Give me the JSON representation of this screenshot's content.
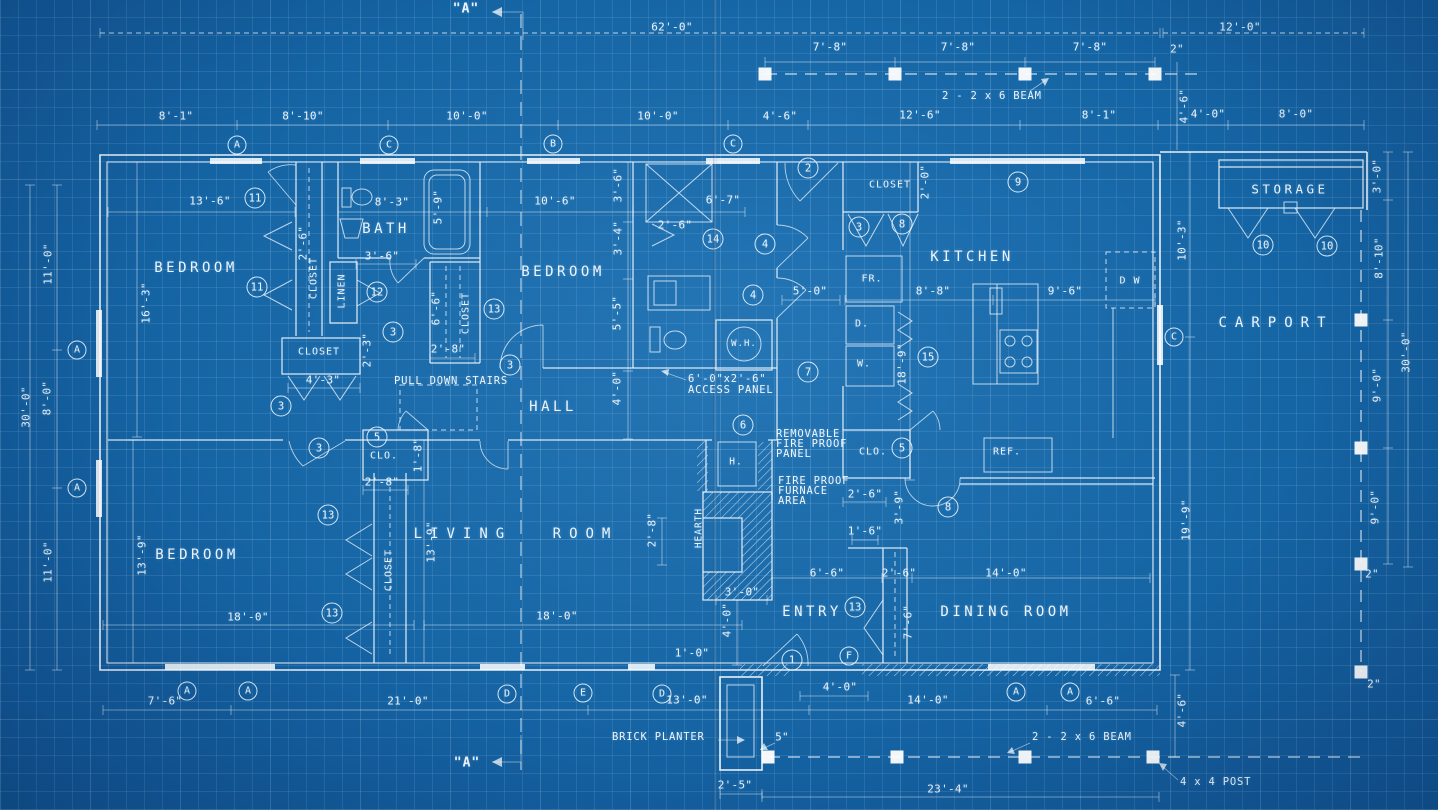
{
  "colors": {
    "paper_blue": "#1565a5",
    "line_white": "#f2f8fd",
    "grid_blue": "#add6f4"
  },
  "sections": [
    {
      "t": "\"A\"",
      "x": 466,
      "y": 9
    },
    {
      "t": "\"A\"",
      "x": 467,
      "y": 763
    }
  ],
  "rooms": [
    {
      "t": "BEDROOM",
      "x": 196,
      "y": 268
    },
    {
      "t": "BEDROOM",
      "x": 563,
      "y": 272
    },
    {
      "t": "BEDROOM",
      "x": 197,
      "y": 555
    },
    {
      "t": "BATH",
      "x": 386,
      "y": 229
    },
    {
      "t": "HALL",
      "x": 553,
      "y": 407
    },
    {
      "t": "KITCHEN",
      "x": 972,
      "y": 257
    },
    {
      "t": "LIVING ROOM",
      "x": 516,
      "y": 534,
      "w": 1
    },
    {
      "t": "ENTRY",
      "x": 812,
      "y": 612
    },
    {
      "t": "DINING ROOM",
      "x": 1006,
      "y": 612
    },
    {
      "t": "STORAGE",
      "x": 1290,
      "y": 189,
      "fs": 12.5
    },
    {
      "t": "CARPORT",
      "x": 1276,
      "y": 323,
      "w": 1
    }
  ],
  "labels": [
    {
      "t": "CLOSET",
      "x": 314,
      "y": 278,
      "r": 1
    },
    {
      "t": "LINEN",
      "x": 342,
      "y": 291,
      "r": 1
    },
    {
      "t": "CLOSET",
      "x": 319,
      "y": 352
    },
    {
      "t": "CLOSET",
      "x": 466,
      "y": 313,
      "r": 1
    },
    {
      "t": "CLOSET",
      "x": 890,
      "y": 185
    },
    {
      "t": "CLOSET",
      "x": 389,
      "y": 570,
      "r": 1
    },
    {
      "t": "CLO.",
      "x": 384,
      "y": 456
    },
    {
      "t": "CLO.",
      "x": 873,
      "y": 452
    },
    {
      "t": "FR.",
      "x": 872,
      "y": 279
    },
    {
      "t": "D.",
      "x": 862,
      "y": 324
    },
    {
      "t": "W.",
      "x": 864,
      "y": 364
    },
    {
      "t": "W.H.",
      "x": 744,
      "y": 344,
      "fs": 9
    },
    {
      "t": "REF.",
      "x": 1007,
      "y": 452
    },
    {
      "t": "D W",
      "x": 1130,
      "y": 281
    },
    {
      "t": "H.",
      "x": 736,
      "y": 462,
      "fs": 9.5
    },
    {
      "t": "HEARTH",
      "x": 699,
      "y": 528,
      "r": 1,
      "fs": 9.5
    }
  ],
  "dims": [
    {
      "t": "62'-0\"",
      "x": 672,
      "y": 27
    },
    {
      "t": "12'-0\"",
      "x": 1240,
      "y": 27
    },
    {
      "t": "7'-8\"",
      "x": 830,
      "y": 47
    },
    {
      "t": "7'-8\"",
      "x": 958,
      "y": 47
    },
    {
      "t": "7'-8\"",
      "x": 1090,
      "y": 47
    },
    {
      "t": "2\"",
      "x": 1177,
      "y": 49
    },
    {
      "t": "8'-1\"",
      "x": 176,
      "y": 116
    },
    {
      "t": "8'-10\"",
      "x": 303,
      "y": 116
    },
    {
      "t": "10'-0\"",
      "x": 467,
      "y": 116
    },
    {
      "t": "10'-0\"",
      "x": 658,
      "y": 116
    },
    {
      "t": "4'-6\"",
      "x": 780,
      "y": 116
    },
    {
      "t": "12'-6\"",
      "x": 920,
      "y": 115
    },
    {
      "t": "8'-1\"",
      "x": 1099,
      "y": 115
    },
    {
      "t": "4'-6\"",
      "x": 1184,
      "y": 106,
      "r": 1
    },
    {
      "t": "4'-0\"",
      "x": 1208,
      "y": 114
    },
    {
      "t": "8'-0\"",
      "x": 1296,
      "y": 114
    },
    {
      "t": "11'-0\"",
      "x": 48,
      "y": 264,
      "r": 1
    },
    {
      "t": "8'-0\"",
      "x": 47,
      "y": 398,
      "r": 1
    },
    {
      "t": "11'-0\"",
      "x": 48,
      "y": 562,
      "r": 1
    },
    {
      "t": "30'-0\"",
      "x": 26,
      "y": 407,
      "r": 1
    },
    {
      "t": "3'-0\"",
      "x": 1377,
      "y": 176,
      "r": 1
    },
    {
      "t": "8'-10\"",
      "x": 1379,
      "y": 258,
      "r": 1
    },
    {
      "t": "9'-0\"",
      "x": 1377,
      "y": 385,
      "r": 1
    },
    {
      "t": "9'-0\"",
      "x": 1375,
      "y": 507,
      "r": 1
    },
    {
      "t": "2\"",
      "x": 1372,
      "y": 574
    },
    {
      "t": "2\"",
      "x": 1374,
      "y": 684
    },
    {
      "t": "30'-0\"",
      "x": 1406,
      "y": 352,
      "r": 1
    },
    {
      "t": "10'-3\"",
      "x": 1182,
      "y": 240,
      "r": 1
    },
    {
      "t": "19'-9\"",
      "x": 1186,
      "y": 520,
      "r": 1
    },
    {
      "t": "13'-6\"",
      "x": 210,
      "y": 201
    },
    {
      "t": "8'-3\"",
      "x": 392,
      "y": 202
    },
    {
      "t": "3'-6\"",
      "x": 382,
      "y": 256
    },
    {
      "t": "2'-6\"",
      "x": 303,
      "y": 243,
      "r": 1
    },
    {
      "t": "2'-3\"",
      "x": 367,
      "y": 350,
      "r": 1
    },
    {
      "t": "4'-3\"",
      "x": 323,
      "y": 380
    },
    {
      "t": "16'-3\"",
      "x": 146,
      "y": 303,
      "r": 1
    },
    {
      "t": "5'-9\"",
      "x": 438,
      "y": 207,
      "r": 1
    },
    {
      "t": "10'-6\"",
      "x": 555,
      "y": 201
    },
    {
      "t": "3'-6\"",
      "x": 618,
      "y": 185,
      "r": 1
    },
    {
      "t": "3'-4\"",
      "x": 618,
      "y": 238,
      "r": 1
    },
    {
      "t": "5'-5\"",
      "x": 617,
      "y": 313,
      "r": 1
    },
    {
      "t": "4'-0\"",
      "x": 617,
      "y": 388,
      "r": 1
    },
    {
      "t": "6'-6\"",
      "x": 436,
      "y": 308,
      "r": 1
    },
    {
      "t": "2'-8\"",
      "x": 448,
      "y": 349
    },
    {
      "t": "6'-7\"",
      "x": 723,
      "y": 200
    },
    {
      "t": "2'-6\"",
      "x": 675,
      "y": 225
    },
    {
      "t": "5'-0\"",
      "x": 810,
      "y": 291
    },
    {
      "t": "2'-0\"",
      "x": 925,
      "y": 182,
      "r": 1
    },
    {
      "t": "8'-8\"",
      "x": 933,
      "y": 291
    },
    {
      "t": "9'-6\"",
      "x": 1065,
      "y": 291
    },
    {
      "t": "18'-9\"",
      "x": 902,
      "y": 364,
      "r": 1
    },
    {
      "t": "2'-8\"",
      "x": 382,
      "y": 482
    },
    {
      "t": "1'-8\"",
      "x": 418,
      "y": 455,
      "r": 1
    },
    {
      "t": "13'-9\"",
      "x": 142,
      "y": 555,
      "r": 1
    },
    {
      "t": "18'-0\"",
      "x": 248,
      "y": 617
    },
    {
      "t": "13'-9\"",
      "x": 431,
      "y": 542,
      "r": 1
    },
    {
      "t": "18'-0\"",
      "x": 557,
      "y": 616
    },
    {
      "t": "2'-8\"",
      "x": 652,
      "y": 530,
      "r": 1
    },
    {
      "t": "3'-0\"",
      "x": 742,
      "y": 592
    },
    {
      "t": "4'-0\"",
      "x": 727,
      "y": 620,
      "r": 1
    },
    {
      "t": "1'-0\"",
      "x": 692,
      "y": 653
    },
    {
      "t": "2'-6\"",
      "x": 865,
      "y": 494
    },
    {
      "t": "3'-9\"",
      "x": 899,
      "y": 507,
      "r": 1
    },
    {
      "t": "1'-6\"",
      "x": 865,
      "y": 531
    },
    {
      "t": "6'-6\"",
      "x": 827,
      "y": 573
    },
    {
      "t": "2'-6\"",
      "x": 899,
      "y": 573
    },
    {
      "t": "14'-0\"",
      "x": 1006,
      "y": 573
    },
    {
      "t": "7'-6\"",
      "x": 908,
      "y": 622,
      "r": 1
    },
    {
      "t": "7'-6\"",
      "x": 165,
      "y": 701
    },
    {
      "t": "21'-0\"",
      "x": 408,
      "y": 701
    },
    {
      "t": "13'-0\"",
      "x": 687,
      "y": 700
    },
    {
      "t": "4'-0\"",
      "x": 840,
      "y": 687
    },
    {
      "t": "14'-0\"",
      "x": 928,
      "y": 700
    },
    {
      "t": "6'-6\"",
      "x": 1103,
      "y": 701
    },
    {
      "t": "4'-6\"",
      "x": 1182,
      "y": 710,
      "r": 1
    },
    {
      "t": "5\"",
      "x": 782,
      "y": 737
    },
    {
      "t": "2'-5\"",
      "x": 735,
      "y": 785
    },
    {
      "t": "23'-4\"",
      "x": 948,
      "y": 789
    }
  ],
  "notes": [
    {
      "t": "PULL DOWN STAIRS",
      "x": 394,
      "y": 381
    },
    {
      "t": "6'-0\"x2'-6\"",
      "x": 688,
      "y": 379
    },
    {
      "t": "ACCESS PANEL",
      "x": 688,
      "y": 390
    },
    {
      "t": "REMOVABLE",
      "x": 776,
      "y": 434
    },
    {
      "t": "FIRE PROOF",
      "x": 776,
      "y": 444
    },
    {
      "t": "PANEL",
      "x": 776,
      "y": 454
    },
    {
      "t": "FIRE PROOF",
      "x": 778,
      "y": 481
    },
    {
      "t": "FURNACE",
      "x": 778,
      "y": 491
    },
    {
      "t": "AREA",
      "x": 778,
      "y": 501
    },
    {
      "t": "BRICK PLANTER",
      "x": 612,
      "y": 737
    },
    {
      "t": "2 - 2 x 6 BEAM",
      "x": 1032,
      "y": 737
    },
    {
      "t": "4 x 4 POST",
      "x": 1180,
      "y": 782
    },
    {
      "t": "2 - 2 x 6 BEAM",
      "x": 942,
      "y": 96
    }
  ],
  "markers": [
    {
      "t": "A",
      "x": 237,
      "y": 145,
      "k": "l"
    },
    {
      "t": "C",
      "x": 389,
      "y": 145,
      "k": "l"
    },
    {
      "t": "B",
      "x": 553,
      "y": 144,
      "k": "l"
    },
    {
      "t": "C",
      "x": 733,
      "y": 144,
      "k": "l"
    },
    {
      "t": "A",
      "x": 77,
      "y": 350,
      "k": "l"
    },
    {
      "t": "A",
      "x": 77,
      "y": 488,
      "k": "l"
    },
    {
      "t": "C",
      "x": 1174,
      "y": 337,
      "k": "l"
    },
    {
      "t": "A",
      "x": 187,
      "y": 691,
      "k": "l"
    },
    {
      "t": "A",
      "x": 248,
      "y": 691,
      "k": "l"
    },
    {
      "t": "D",
      "x": 507,
      "y": 694,
      "k": "l"
    },
    {
      "t": "E",
      "x": 583,
      "y": 693,
      "k": "l"
    },
    {
      "t": "D",
      "x": 662,
      "y": 694,
      "k": "l"
    },
    {
      "t": "F",
      "x": 849,
      "y": 656,
      "k": "l"
    },
    {
      "t": "A",
      "x": 1016,
      "y": 692,
      "k": "l"
    },
    {
      "t": "A",
      "x": 1070,
      "y": 692,
      "k": "l"
    },
    {
      "t": "2",
      "x": 808,
      "y": 168,
      "k": "n"
    },
    {
      "t": "3",
      "x": 859,
      "y": 227,
      "k": "n"
    },
    {
      "t": "8",
      "x": 902,
      "y": 224,
      "k": "n"
    },
    {
      "t": "9",
      "x": 1018,
      "y": 182,
      "k": "n"
    },
    {
      "t": "11",
      "x": 255,
      "y": 198,
      "k": "n"
    },
    {
      "t": "11",
      "x": 257,
      "y": 287,
      "k": "n"
    },
    {
      "t": "12",
      "x": 377,
      "y": 292,
      "k": "n"
    },
    {
      "t": "13",
      "x": 494,
      "y": 309,
      "k": "n"
    },
    {
      "t": "14",
      "x": 713,
      "y": 239,
      "k": "n"
    },
    {
      "t": "4",
      "x": 765,
      "y": 244,
      "k": "n"
    },
    {
      "t": "4",
      "x": 753,
      "y": 295,
      "k": "n"
    },
    {
      "t": "7",
      "x": 808,
      "y": 372,
      "k": "n"
    },
    {
      "t": "3",
      "x": 393,
      "y": 332,
      "k": "n"
    },
    {
      "t": "3",
      "x": 281,
      "y": 406,
      "k": "n"
    },
    {
      "t": "3",
      "x": 510,
      "y": 365,
      "k": "n"
    },
    {
      "t": "15",
      "x": 928,
      "y": 357,
      "k": "n"
    },
    {
      "t": "6",
      "x": 743,
      "y": 425,
      "k": "n"
    },
    {
      "t": "5",
      "x": 377,
      "y": 437,
      "k": "n"
    },
    {
      "t": "3",
      "x": 319,
      "y": 448,
      "k": "n"
    },
    {
      "t": "13",
      "x": 328,
      "y": 515,
      "k": "n"
    },
    {
      "t": "13",
      "x": 332,
      "y": 613,
      "k": "n"
    },
    {
      "t": "5",
      "x": 902,
      "y": 448,
      "k": "n"
    },
    {
      "t": "8",
      "x": 948,
      "y": 507,
      "k": "n"
    },
    {
      "t": "13",
      "x": 855,
      "y": 607,
      "k": "n"
    },
    {
      "t": "1",
      "x": 792,
      "y": 660,
      "k": "n"
    },
    {
      "t": "10",
      "x": 1263,
      "y": 245,
      "k": "n"
    },
    {
      "t": "10",
      "x": 1327,
      "y": 246,
      "k": "n"
    }
  ]
}
